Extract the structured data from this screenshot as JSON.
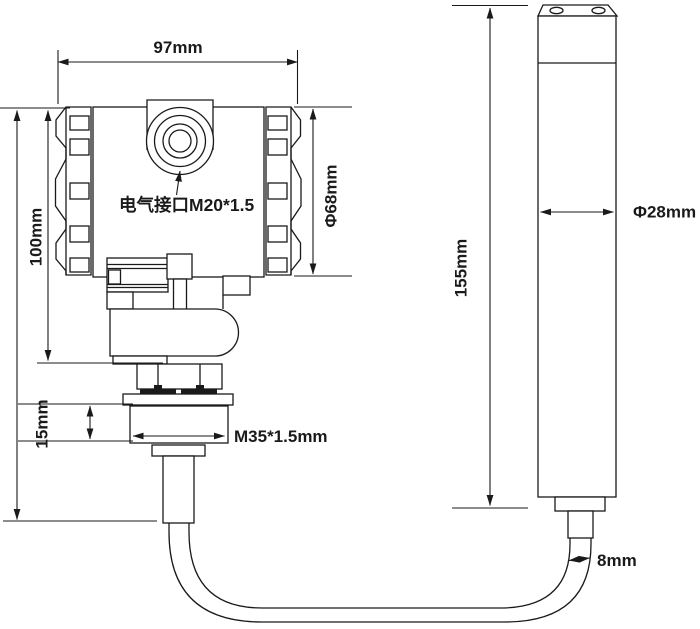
{
  "diagram": {
    "device_left": {
      "port_label": "电气接口M20*1.5",
      "width_dim": "97mm",
      "height_dim": "100mm",
      "housing_diameter_dim": "Φ68mm",
      "thread_height_dim": "15mm",
      "thread_spec_label": "M35*1.5mm"
    },
    "device_right": {
      "probe_length_dim": "155mm",
      "probe_diameter_dim": "Φ28mm",
      "cable_diameter_dim": "8mm"
    },
    "colors": {
      "line_color": "#1a1a1a",
      "background_color": "#ffffff"
    }
  }
}
